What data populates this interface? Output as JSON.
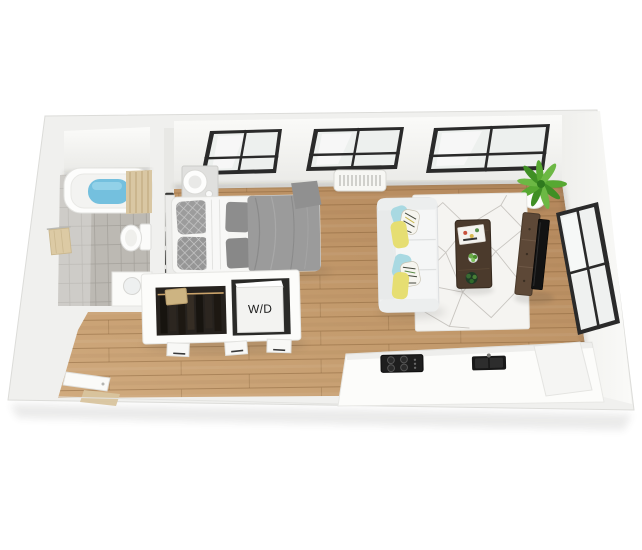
{
  "floorplan": {
    "description": "3D top-down rendering of a studio apartment floor plan",
    "labels": {
      "washer_dryer": "W/D"
    },
    "windows": {
      "north_wall_count": 3,
      "east_wall_count": 1
    },
    "colors": {
      "background": "#ffffff",
      "wall": "#f0f0ee",
      "wall_face": "#f8f8f6",
      "wood_floor": "#c2996b",
      "tile_floor": "#bcb9b3",
      "tub_water": "#74c0de",
      "shower_curtain": "#d9c7a3",
      "window_frame": "#2a2a2a",
      "window_glass": "#edf0ee",
      "bedding_gray": "#9b9b9b",
      "sofa_white": "#f1f2f2",
      "pillow_teal": "#a9d9e2",
      "pillow_yellow": "#e6de72",
      "rug": "#f5f4f1",
      "rug_pattern": "#c8c5c0",
      "coffee_table_wood": "#4b3a2c",
      "tv_console_wood": "#5d4837",
      "tv_screen": "#121212",
      "plant_green": "#57a832",
      "appliance_black": "#1e1e1e",
      "towel_tan": "#dccaa4",
      "closet_interior": "#26221e",
      "hanger_rod_tan": "#caa36a"
    },
    "rooms": [
      {
        "name": "bathroom",
        "items": [
          "bathtub",
          "shower-curtain",
          "toilet",
          "towel-rack",
          "vanity-sink",
          "tile-floor"
        ]
      },
      {
        "name": "sleeping-area",
        "items": [
          "bed",
          "gray-duvet",
          "pillows",
          "nightstand",
          "table-lamp",
          "wall-frames"
        ]
      },
      {
        "name": "closet-laundry",
        "items": [
          "hanging-clothes",
          "storage-box",
          "washer-dryer-unit"
        ]
      },
      {
        "name": "living-area",
        "items": [
          "sofa",
          "throw-pillows",
          "geometric-rug",
          "coffee-table",
          "tv-console",
          "tv",
          "corner-plant",
          "ac-unit"
        ]
      },
      {
        "name": "kitchen",
        "items": [
          "counter",
          "range-cooktop",
          "sink"
        ]
      },
      {
        "name": "entry",
        "items": [
          "entry-door"
        ]
      }
    ]
  }
}
